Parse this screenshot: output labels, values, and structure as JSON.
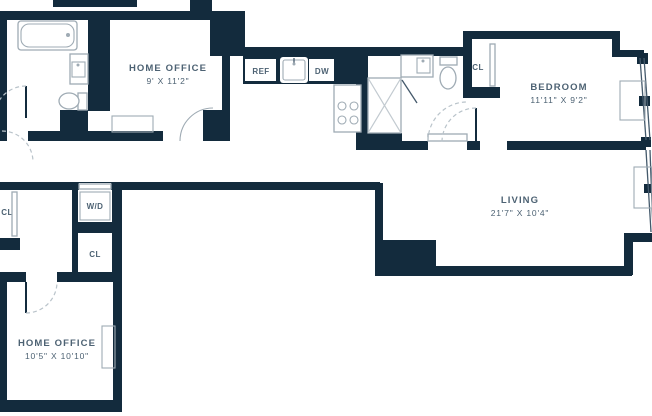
{
  "plan": {
    "title": "apartment-floor-plan",
    "type": "floor_plan",
    "colors": {
      "wall": "#132b3d",
      "label": "#4d6273",
      "fixture": "#9fabb4",
      "dash": "#b9c3ca",
      "glazing": "#44596b",
      "showerx": "#c2cad0",
      "bg": "#ffffff"
    },
    "rooms": [
      {
        "id": "home-office-1",
        "name": "HOME OFFICE",
        "dims": "9' X 11'2\""
      },
      {
        "id": "bedroom",
        "name": "BEDROOM",
        "dims": "11'11\" X 9'2\""
      },
      {
        "id": "living",
        "name": "LIVING",
        "dims": "21'7\" X 10'4\""
      },
      {
        "id": "home-office-2",
        "name": "HOME OFFICE",
        "dims": "10'5\" X 10'10\""
      }
    ],
    "labels": [
      {
        "id": "refrigerator",
        "text": "REF"
      },
      {
        "id": "dishwasher",
        "text": "DW"
      },
      {
        "id": "closet-bedroom",
        "text": "CL"
      },
      {
        "id": "washer-dryer",
        "text": "W/D"
      },
      {
        "id": "closet-left",
        "text": "CL"
      },
      {
        "id": "closet-hall",
        "text": "CL"
      }
    ],
    "fixtures": [
      "bathtub",
      "bathroom-sink",
      "toilet",
      "kitchen-sink",
      "stove",
      "shower",
      "second-bathroom-sink",
      "second-toilet",
      "washer-dryer",
      "desk",
      "ptac-unit",
      "windows"
    ]
  }
}
